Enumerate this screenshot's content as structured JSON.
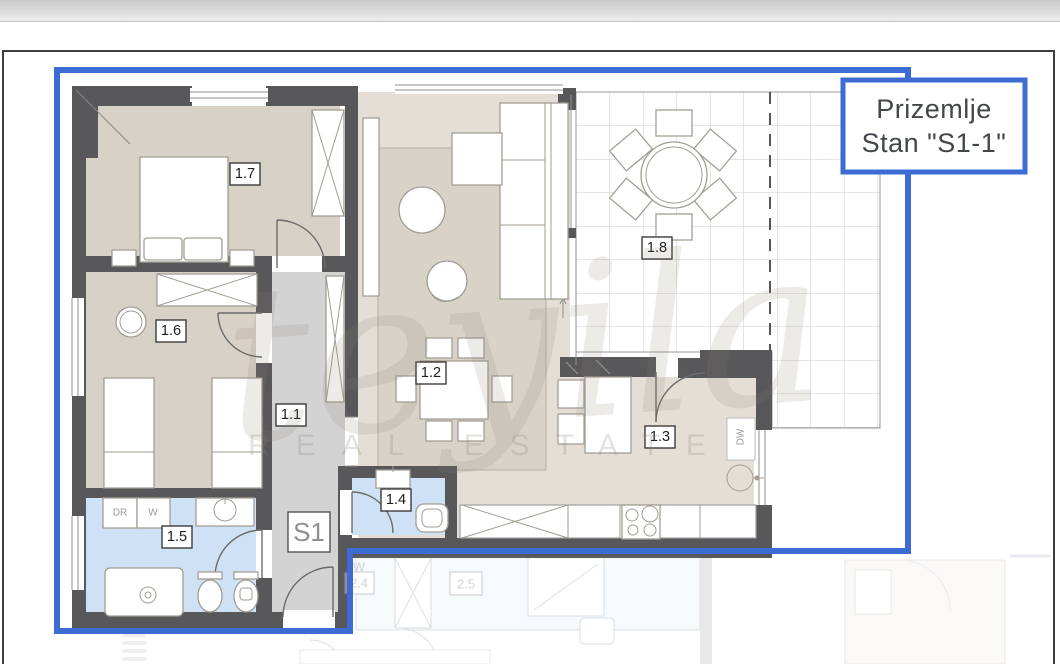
{
  "title_box": {
    "line1": "Prizemlje",
    "line2": "Stan \"S1-1\""
  },
  "unit_label": "S1",
  "room_labels": {
    "hallway": "1.1",
    "living_dining": "1.2",
    "kitchen": "1.3",
    "wc": "1.4",
    "bathroom": "1.5",
    "bedroom2": "1.6",
    "bedroom1": "1.7",
    "terrace": "1.8"
  },
  "appliance_labels": {
    "dryer": "DR",
    "washer": "W",
    "dishwasher": "DW"
  },
  "neighbor_labels": {
    "room24": "2.4",
    "room25": "2.5",
    "washer": "W"
  },
  "watermark": {
    "script": "teyila",
    "subtext": "REAL ESTATE"
  },
  "colors": {
    "outline_blue": "#3d6bd4",
    "wall": "#58585a",
    "floor_beige": "#d8d1c8",
    "floor_light": "#e4ded7",
    "corridor_gray": "#d3d3d4",
    "bath_blue": "#cfe1f4",
    "terrace_grid": "#cbcbcb"
  }
}
